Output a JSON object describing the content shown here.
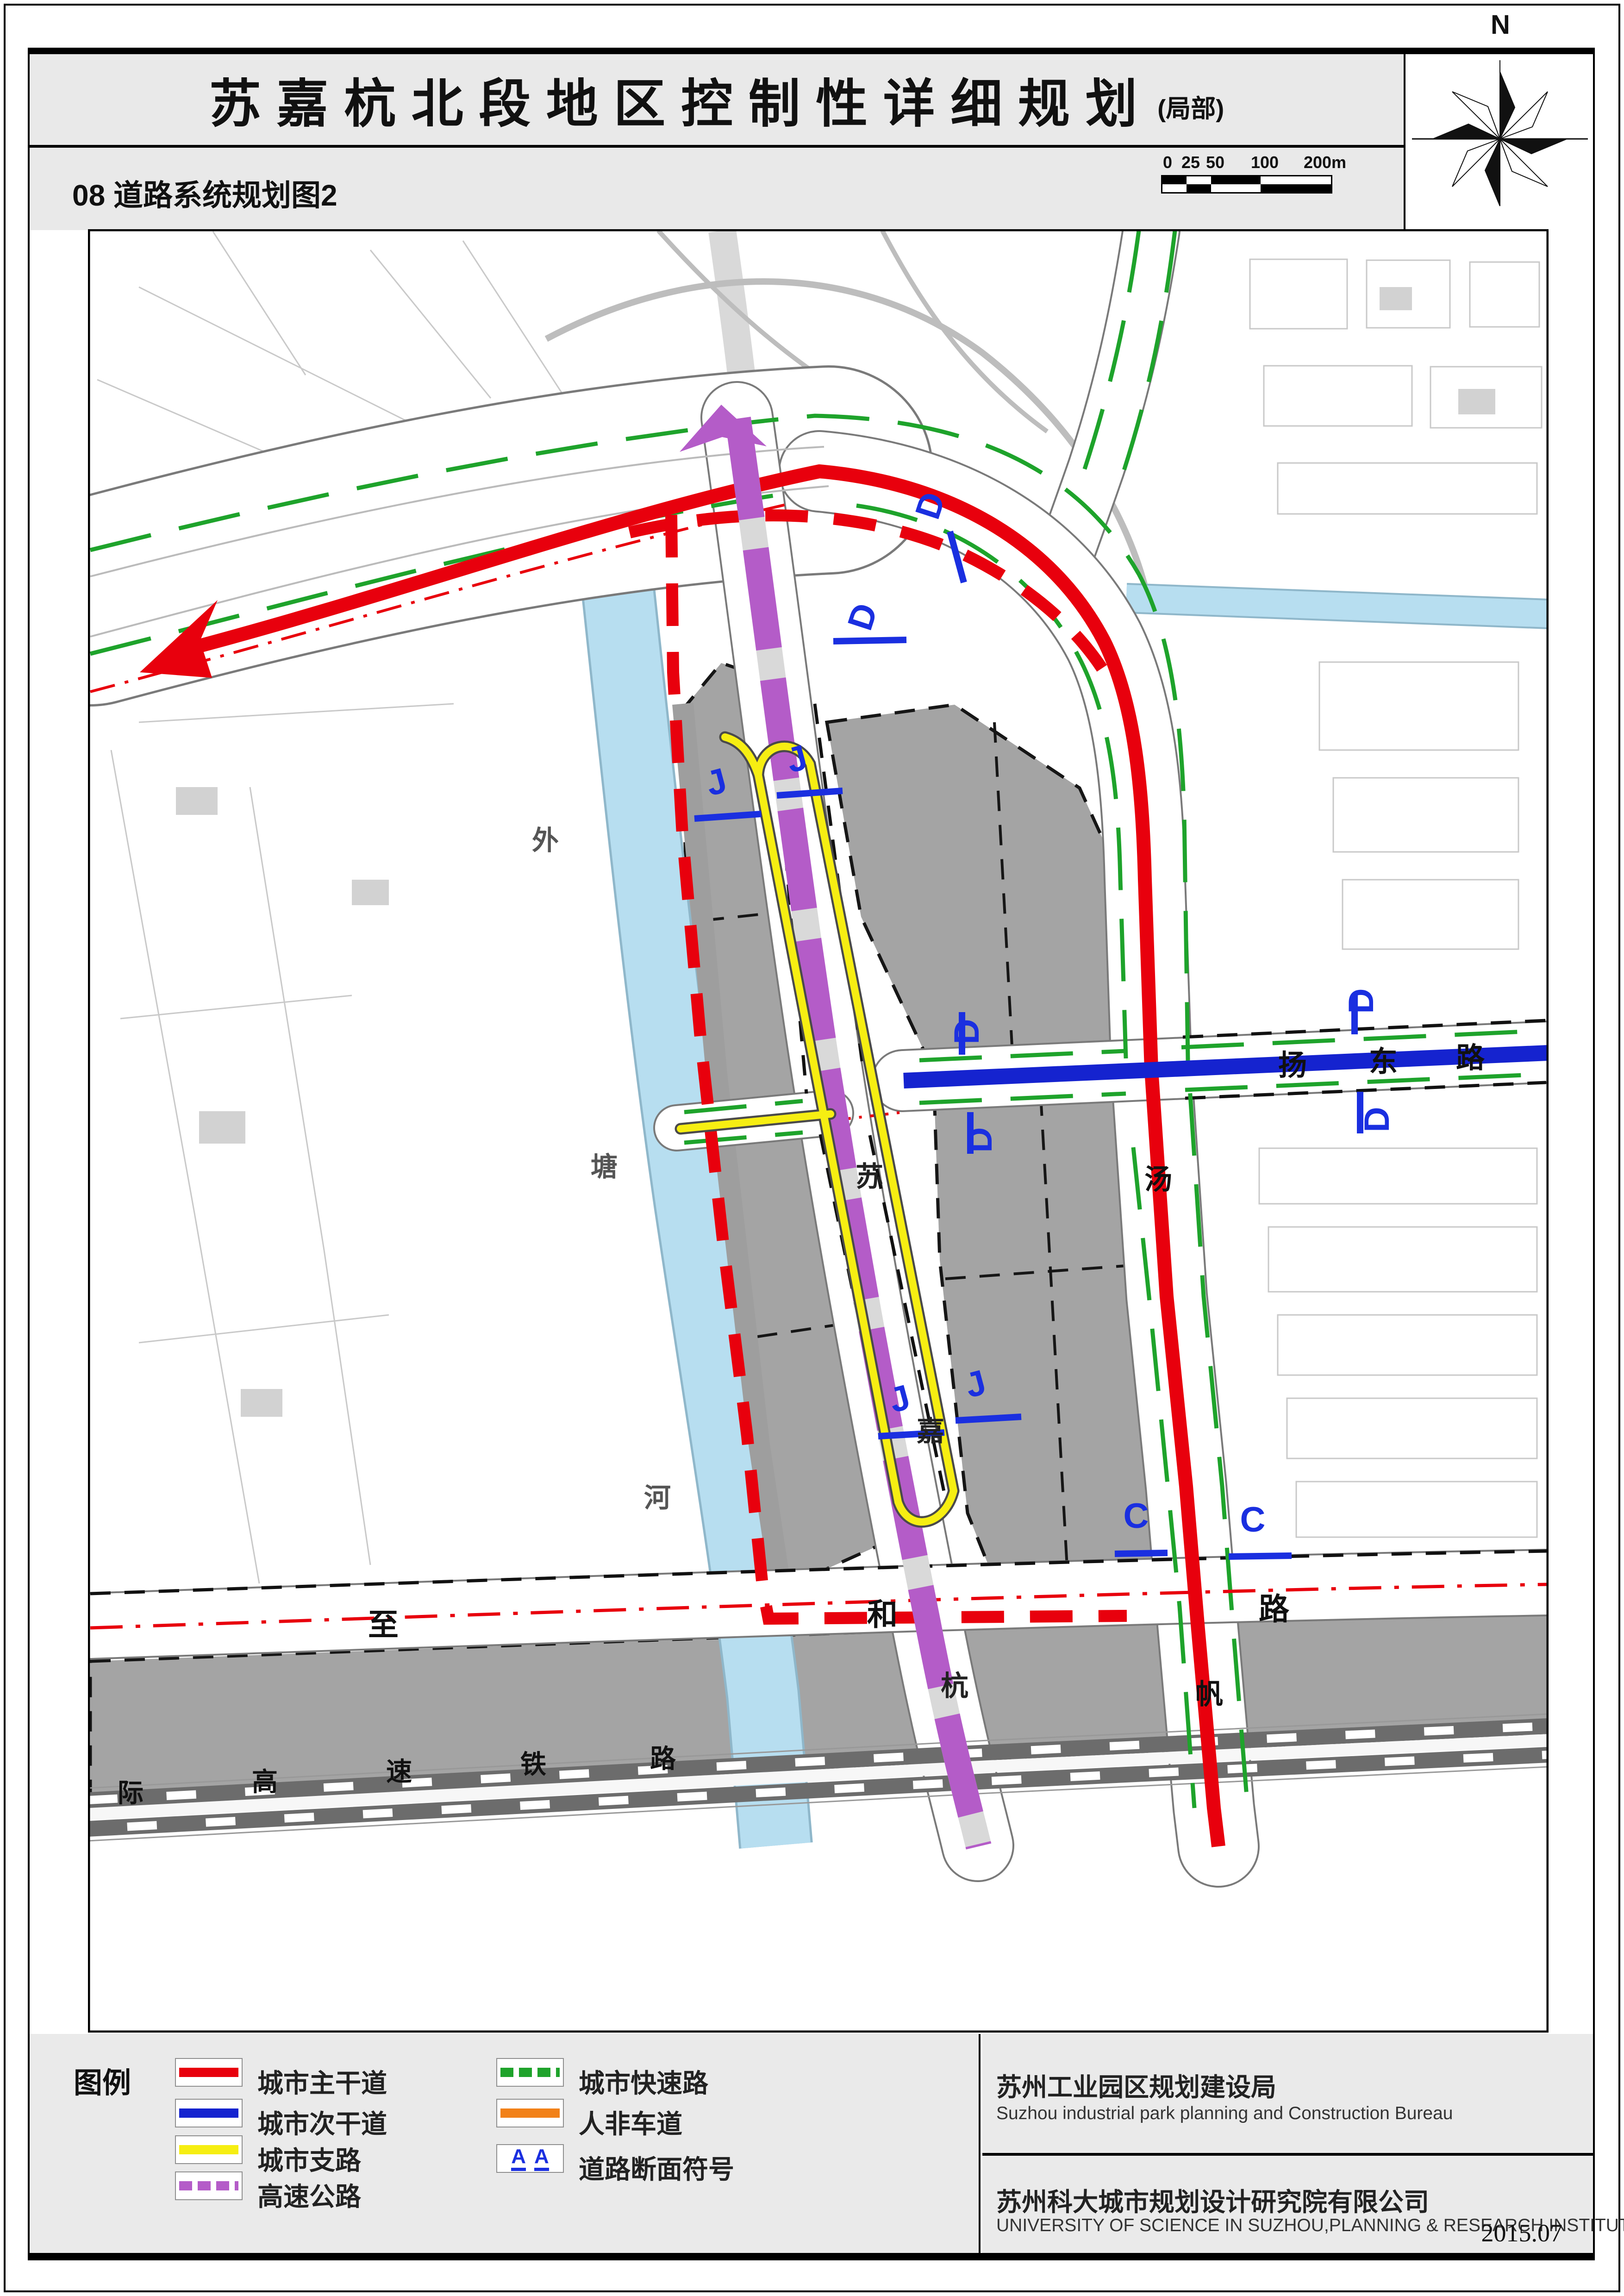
{
  "page": {
    "title": "苏嘉杭北段地区控制性详细规划",
    "title_suffix": "(局部)",
    "subtitle": "08 道路系统规划图2",
    "north_label": "N",
    "date": "2015.07"
  },
  "scalebar": {
    "ticks": [
      "0",
      "25",
      "50",
      "100",
      "200m"
    ]
  },
  "colors": {
    "red": "#e8000d",
    "blue": "#1523cf",
    "yellow": "#f6ee12",
    "purple": "#b45cc8",
    "green": "#1ea32b",
    "orange": "#f28118",
    "water": "#b7def0",
    "block": "#a4a4a4",
    "rail": "#6c6c6c",
    "section": "#1a2fe0"
  },
  "map": {
    "labels": {
      "waitang": [
        "外",
        "塘",
        "河"
      ],
      "sujiahang": [
        "苏",
        "嘉",
        "杭"
      ],
      "yangdong": [
        "扬",
        "东",
        "路"
      ],
      "zhihe": [
        "至",
        "和",
        "路"
      ],
      "tangfan": [
        "汤",
        "帆"
      ],
      "railway": [
        "际",
        "高",
        "速",
        "铁",
        "路"
      ]
    },
    "sections": {
      "d": "D",
      "j": "J",
      "c": "C"
    }
  },
  "legend": {
    "title": "图例",
    "section_symbol": "A",
    "items": [
      {
        "label": "城市主干道"
      },
      {
        "label": "城市次干道"
      },
      {
        "label": "城市支路"
      },
      {
        "label": "高速公路"
      },
      {
        "label": "城市快速路"
      },
      {
        "label": "人非车道"
      },
      {
        "label": "道路断面符号"
      }
    ]
  },
  "credits": {
    "bureau_cn": "苏州工业园区规划建设局",
    "bureau_en": "Suzhou industrial park planning and Construction Bureau",
    "institute_cn": "苏州科大城市规划设计研究院有限公司",
    "institute_en": "UNIVERSITY OF SCIENCE  IN SUZHOU,PLANNING & RESEARCH INSTITUTE CO.,LTD."
  }
}
